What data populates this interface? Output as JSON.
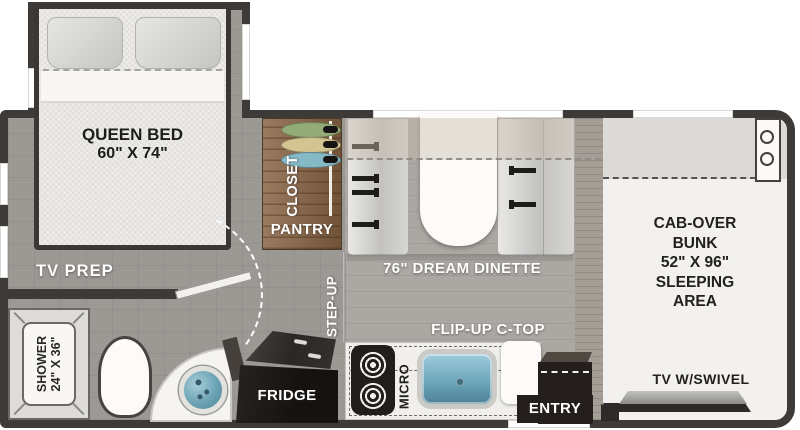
{
  "title": "RV floor plan",
  "labels": {
    "queen_bed_1": "QUEEN BED",
    "queen_bed_2": "60\" X 74\"",
    "tv_prep": "TV PREP",
    "closet": "CLOSET",
    "pantry": "PANTRY",
    "shower_1": "SHOWER",
    "shower_2": "24\" X 36\"",
    "step_up": "STEP-UP",
    "dinette": "76\" DREAM DINETTE",
    "flip_up_ctop": "FLIP-UP C-TOP",
    "fridge": "FRIDGE",
    "micro": "MICRO",
    "entry": "ENTRY",
    "cab_1": "CAB-OVER",
    "cab_2": "BUNK",
    "cab_3": "52\" X 96\"",
    "cab_4": "SLEEPING",
    "cab_5": "AREA",
    "tv_swivel": "TV W/SWIVEL"
  },
  "colors": {
    "wall": "#3e3a37",
    "floor_bedroom": "#9c9894",
    "floor_galley": "#aba7a2",
    "closet_wood": "#8a6545",
    "cabinet_dark": "#201c19",
    "sink_blue": "#5d96ac",
    "cab_floor": "#f2f1ef",
    "label_light": "#ffffff",
    "label_dark": "#23211f"
  }
}
